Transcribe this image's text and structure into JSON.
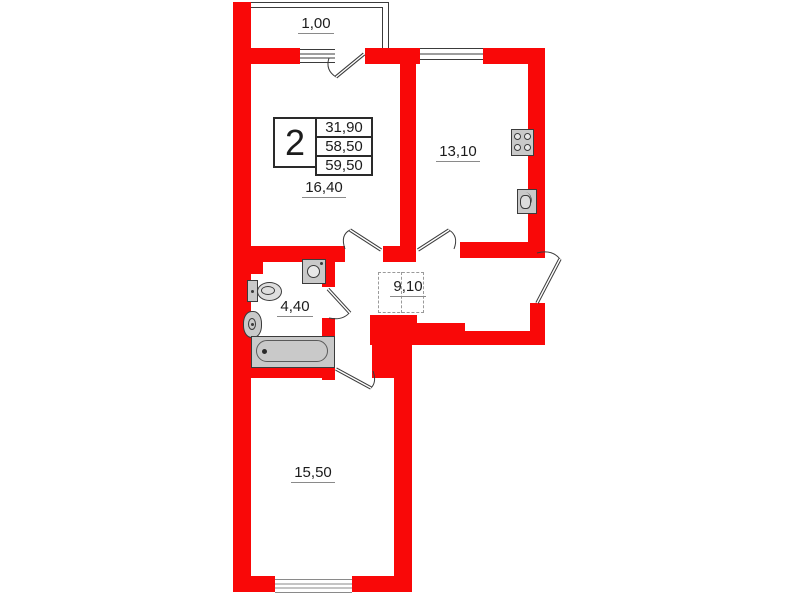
{
  "plan": {
    "type_table": {
      "rooms": "2",
      "values": [
        "31,90",
        "58,50",
        "59,50"
      ]
    },
    "labels": {
      "balcony": "1,00",
      "living": "16,40",
      "kitchen": "13,10",
      "bathroom": "4,40",
      "hallway": "9,10",
      "bedroom": "15,50"
    },
    "colors": {
      "wall": "#f90808",
      "line": "#3b3b3b",
      "fixture_fill": "#c9c9c9",
      "label_underline": "#8a8a8a"
    }
  }
}
